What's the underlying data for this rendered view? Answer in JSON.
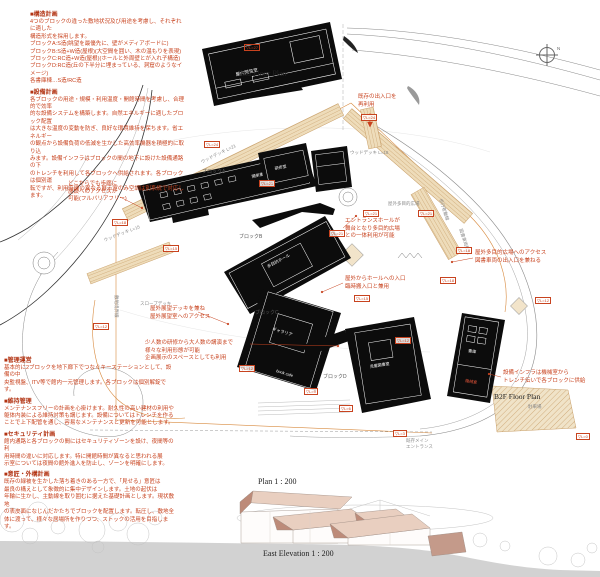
{
  "titles": {
    "plan_2f": "2nd Floor Plan",
    "plan_b2f": "B2F Floor Plan",
    "plan_main": "Plan    1 : 200",
    "elevation": "East  Elevation    1 : 200",
    "north": "N"
  },
  "colors": {
    "annotation_red": "#c8431f",
    "building_black": "#0c0c0c",
    "deck_tan": "#eedcba",
    "deck_stripe": "#c9a06a",
    "boundary_orange": "#d88a3f",
    "ground_gray": "#d2d2d2",
    "roof_light": "#e9cfc0",
    "roof_dark": "#bd8b79"
  },
  "notes": [
    {
      "header": "■構造計画",
      "lines": [
        "4つのブロックの違った敷地状況及び用途を考慮し、それぞれに適した",
        "構造形式を採用します。",
        "ブロックA:S造(眺望を最優先に、壁がメディアボードに)",
        "ブロックB:S造+W造(屋根)(大空間を囲い、木の温もりを表現)",
        "ブロックC:RC造+W造(屋根)(ホールと外周壁とが入れ子構造)",
        "ブロックD:RC造(丘の下半分に埋まっている、洞窟のようなイメージ)",
        "各書庫棟…S造/RC造"
      ]
    },
    {
      "header": "■設備計画",
      "lines": [
        "各ブロックの用途・規模・利用温度・開館時間を考慮し、合理的で効率",
        "的な設備システムを構築します。自然エネルギーに適したブロック配置",
        "は大きな温度の変動を防ぎ、良好な環境維持を保ちます。省エネルギー",
        "の観点から設備負荷の低減を生かした高効率機器を積極的に取り込",
        "みます。設備インフラはブロックの間の地下に設けた設備通路の下",
        "のトレンチを利用して各ブロックへ供給されます。各ブロックは個別運",
        "転ですが、利用時間の異なる展示室のみ空調は別系統で対応します。"
      ]
    },
    {
      "header": "■管理運営",
      "lines": [
        "基本的に2ブロックを地下廊下でつなぐキーステーションとして、設備の中",
        "央監視盤、ITV等で館内一元管理します。各ブロックは個別解錠です。"
      ]
    },
    {
      "header": "■維持管理",
      "lines": [
        "メンテナンスフリーの計画を心掛けます。耐久性の高い建材の利用や",
        "躯体内装による維持対策も講じます。設備についてはトレンチを作る",
        "ことで上下配管を通し、容易なメンテナンスと更新を可能とします。"
      ]
    },
    {
      "header": "■セキュリティ計画",
      "lines": [
        "館内通路と各ブロックの間にはセキュリティゾーンを設け、夜間等の利",
        "用時間の違いに対応します。特に開館時間が異なると思われる展",
        "示室については夜間の館外進入を防止し、ゾーンを明確にします。"
      ]
    },
    {
      "header": "■意匠・外構計画",
      "lines": [
        "既存の緑被を生かした落ち着きのある一方で、「見せる」意匠は",
        "最良の構えとして象徴的に集中デザインします。土地の起伏は",
        "年輪に生かし、主動線を取り囲むに据えた基礎計画とします。現状敷地",
        "の表皮面になじんだかたちでブロックを配置します。転圧し、敷地全",
        "体に渡って、様々な居場所を作りつつ、ストックの活用を目指します。"
      ]
    }
  ],
  "annotations": [
    {
      "id": "access",
      "lines": [
        "どこからでも歩廊に",
        "施設へのアクセスが",
        "可能(フルバリアフリー)"
      ]
    },
    {
      "id": "existing-entrance",
      "lines": [
        "既存の出入口を",
        "再利用"
      ]
    },
    {
      "id": "entrance-hall",
      "lines": [
        "エントランスホールが",
        "舞台となり多目的広場",
        "との一体利用が可能"
      ]
    },
    {
      "id": "plaza-access",
      "lines": [
        "屋外多目的広場へのアクセス",
        "図書車両の出入口を兼ねる"
      ]
    },
    {
      "id": "hall-entrance",
      "lines": [
        "屋外からホールへの入口",
        "臨時搬入口と兼用"
      ]
    },
    {
      "id": "hall-use",
      "lines": [
        "少人数の研修から大人数の講演まで",
        "様々な利用形態が可能",
        "企画展示のスペースとしても利用"
      ]
    },
    {
      "id": "slope-deck",
      "lines": [
        "屋外展望デッキを兼ね",
        "屋外展望室へのアクセス"
      ]
    },
    {
      "id": "infra",
      "lines": [
        "設備インフラは機械室から",
        "トレンチ伝いで各ブロックに供給"
      ]
    }
  ],
  "blocks": [
    "ブロックA",
    "ブロックB",
    "ブロックC",
    "ブロックD"
  ],
  "rooms": {
    "reading": "屋内閲覧室",
    "stack_open": "開架書架",
    "training": "研修室",
    "hall": "多目的ホール",
    "galleria": "ギャラリア",
    "cafe": "book cafe",
    "children": "児童図書室",
    "stack": "書庫",
    "machine": "機械室"
  },
  "gray_labels": {
    "plaza": "屋外多目的広場",
    "slope": "スロープデッキ",
    "main1": "既存メイン",
    "main2": "エントランス",
    "deck21": "ウッドデッキ L=21",
    "deck18": "ウッドデッキ L=18",
    "deck15": "ウッドデッキ L=15",
    "boundary": "敷地境界線",
    "ped": "歩行者動線",
    "book": "図書車両動線",
    "parking": "駐車場"
  },
  "mini": [
    "▽L=27",
    "▽L=24",
    "▽L=24",
    "▽L=21",
    "▽L=21",
    "▽L=21",
    "▽L=21",
    "▽L=18",
    "▽L=18",
    "▽L=15",
    "▽L=15",
    "▽L=12",
    "▽L=12",
    "▽L=12",
    "▽L=9",
    "▽L=6",
    "▽L=3",
    "▽L=0",
    "▽L=18",
    "▽L=12"
  ]
}
